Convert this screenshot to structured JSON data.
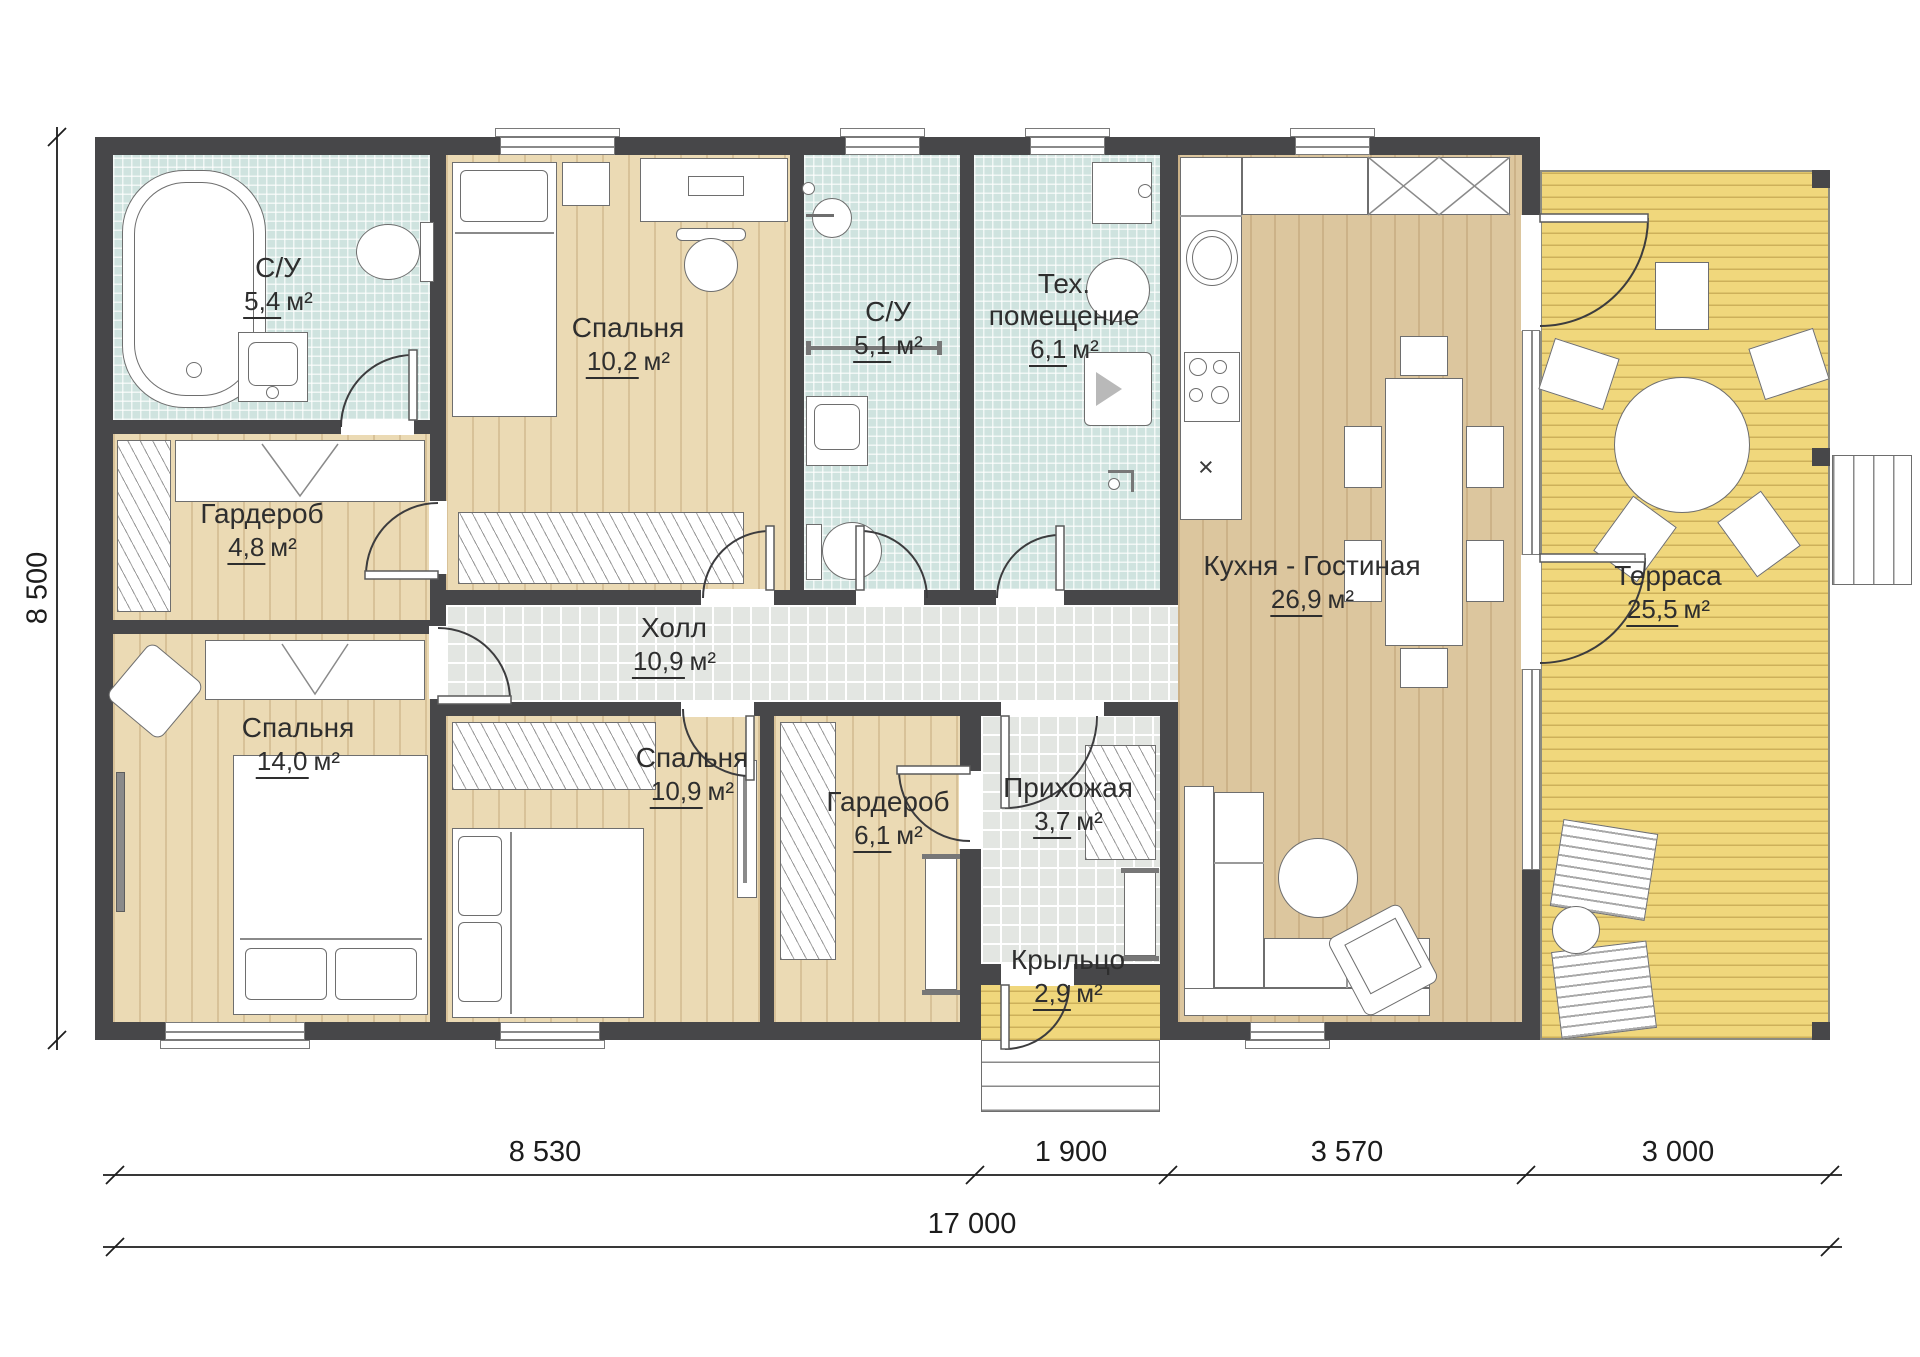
{
  "title": "План одноэтажного дома",
  "rooms": [
    {
      "id": "bathroom-1",
      "name": "С/У",
      "area": "5,4",
      "unit": "м²"
    },
    {
      "id": "wardrobe-1",
      "name": "Гардероб",
      "area": "4,8",
      "unit": "м²"
    },
    {
      "id": "bedroom-1",
      "name": "Спальня",
      "area": "14,0",
      "unit": "м²"
    },
    {
      "id": "bedroom-2",
      "name": "Спальня",
      "area": "10,2",
      "unit": "м²"
    },
    {
      "id": "bathroom-2",
      "name": "С/У",
      "area": "5,1",
      "unit": "м²"
    },
    {
      "id": "tech-room",
      "name": "Тех. помещение",
      "area": "6,1",
      "unit": "м²"
    },
    {
      "id": "hall",
      "name": "Холл",
      "area": "10,9",
      "unit": "м²"
    },
    {
      "id": "kitchen-living",
      "name": "Кухня - Гостиная",
      "area": "26,9",
      "unit": "м²"
    },
    {
      "id": "terrace",
      "name": "Терраса",
      "area": "25,5",
      "unit": "м²"
    },
    {
      "id": "bedroom-3",
      "name": "Спальня",
      "area": "10,9",
      "unit": "м²"
    },
    {
      "id": "wardrobe-2",
      "name": "Гардероб",
      "area": "6,1",
      "unit": "м²"
    },
    {
      "id": "entry",
      "name": "Прихожая",
      "area": "3,7",
      "unit": "м²"
    },
    {
      "id": "porch",
      "name": "Крыльцо",
      "area": "2,9",
      "unit": "м²"
    }
  ],
  "dimensions": {
    "bottom_segments": [
      "8 530",
      "1 900",
      "3 570",
      "3 000"
    ],
    "bottom_total": "17 000",
    "left_total": "8 500"
  },
  "kitchen": {
    "x_marker": "×"
  },
  "colors": {
    "wall": "#474749",
    "wood_floor": "#ebdab4",
    "kitchen_floor": "#dcc69e",
    "bath_tile": "#cfe3df",
    "hall_tile": "#e3e6e2",
    "deck": "#f0d77c",
    "line": "#6e6e6e"
  }
}
